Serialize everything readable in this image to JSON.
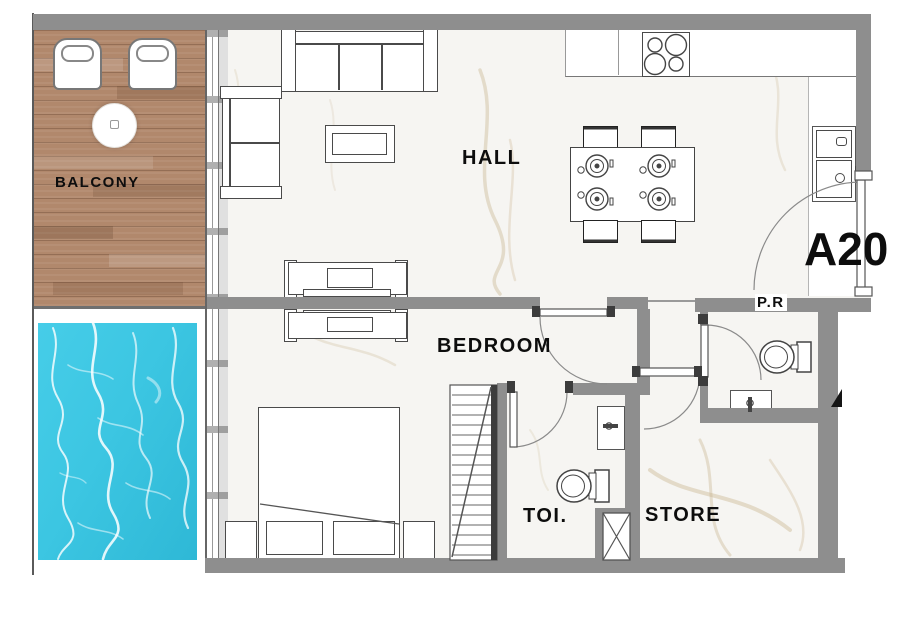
{
  "plan": {
    "unit_label": "A20",
    "labels": {
      "balcony": "BALCONY",
      "hall": "HALL",
      "bedroom": "BEDROOM",
      "toilet": "TOI.",
      "store": "STORE",
      "powder_room": "P.R"
    },
    "rooms": [
      {
        "id": "balcony",
        "label": "BALCONY",
        "floor": "wood-deck"
      },
      {
        "id": "pool",
        "label": "",
        "floor": "water"
      },
      {
        "id": "hall",
        "label": "HALL",
        "floor": "marble"
      },
      {
        "id": "bedroom",
        "label": "BEDROOM",
        "floor": "marble"
      },
      {
        "id": "toilet",
        "label": "TOI.",
        "floor": "marble"
      },
      {
        "id": "store",
        "label": "STORE",
        "floor": "marble"
      },
      {
        "id": "powder_room",
        "label": "P.R",
        "floor": "marble"
      }
    ],
    "colors": {
      "wall": "#8e8e8e",
      "wood": "#b1886c",
      "pool": "#3cc6e2",
      "marble": "#f6f5f2",
      "line": "#4a4a4a",
      "ink": "#0d0d0d"
    }
  }
}
